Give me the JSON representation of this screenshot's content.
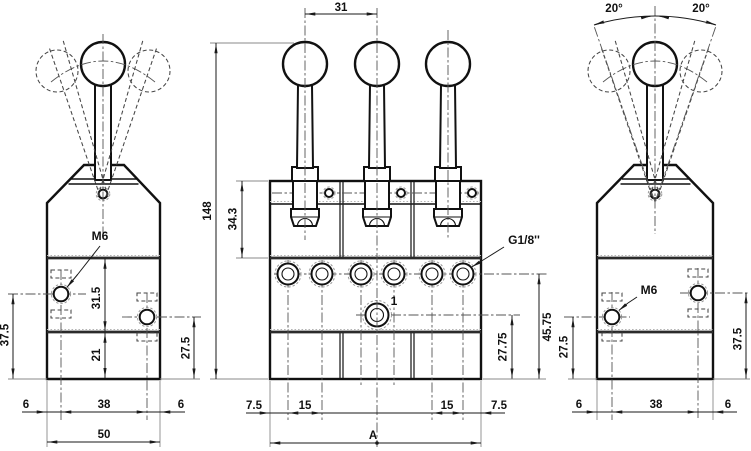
{
  "meta": {
    "type": "technical-dimension-drawing",
    "subject": "three-lever manual valve, orthographic views",
    "background_color": "#ffffff",
    "line_color": "#1a1a1a"
  },
  "views": {
    "left_side": {
      "labels": {
        "thread": "M6"
      },
      "dims": {
        "mid_section_height": "31.5",
        "base_height": "21",
        "left_hole_height": "37.5",
        "right_hole_height": "27.5",
        "edge_left": "6",
        "hole_spacing": "38",
        "edge_right": "6",
        "overall_width": "50"
      }
    },
    "front": {
      "labels": {
        "port_thread": "G1/8''",
        "port_number": "1"
      },
      "dims": {
        "lever_spacing": "31",
        "overall_height": "148",
        "cap_section_height": "34.3",
        "port_row_height": "45.75",
        "port1_height": "27.75",
        "edge_left": "7.5",
        "port_spacing_left": "15",
        "port_spacing_right": "15",
        "edge_right": "7.5",
        "overall_width": "A"
      }
    },
    "right_side": {
      "labels": {
        "thread": "M6"
      },
      "dims": {
        "lever_angle_left": "20°",
        "lever_angle_right": "20°",
        "left_hole_height": "27.5",
        "right_hole_height": "37.5",
        "edge_left": "6",
        "hole_spacing": "38",
        "edge_right": "6"
      }
    }
  }
}
